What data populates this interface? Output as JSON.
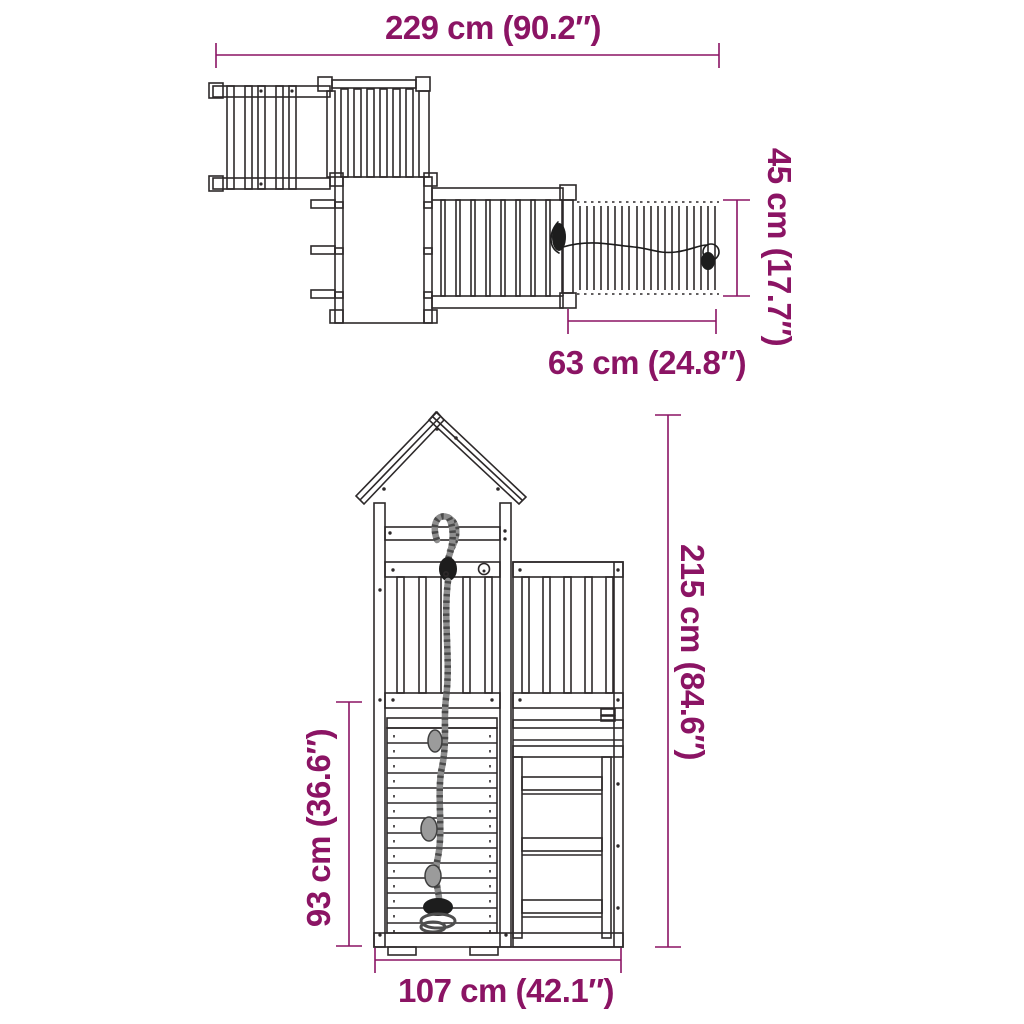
{
  "canvas": {
    "background": "#ffffff",
    "accent_color": "#8b1464",
    "line_color": "#2d292a"
  },
  "diagram": {
    "name": "wooden play tower dimension drawing",
    "views": {
      "top": {
        "name": "top view"
      },
      "front": {
        "name": "front view"
      }
    },
    "dimensions": {
      "total_width": {
        "label": "229 cm (90.2″)",
        "cm": 229,
        "inches": 90.2
      },
      "bridge_depth": {
        "label": "45 cm (17.7″)",
        "cm": 45,
        "inches": 17.7
      },
      "bridge_length": {
        "label": "63 cm (24.8″)",
        "cm": 63,
        "inches": 24.8
      },
      "total_height": {
        "label": "215 cm (84.6″)",
        "cm": 215,
        "inches": 84.6
      },
      "climbing_wall_height": {
        "label": "93 cm (36.6″)",
        "cm": 93,
        "inches": 36.6
      },
      "base_width": {
        "label": "107 cm (42.1″)",
        "cm": 107,
        "inches": 42.1
      }
    }
  }
}
